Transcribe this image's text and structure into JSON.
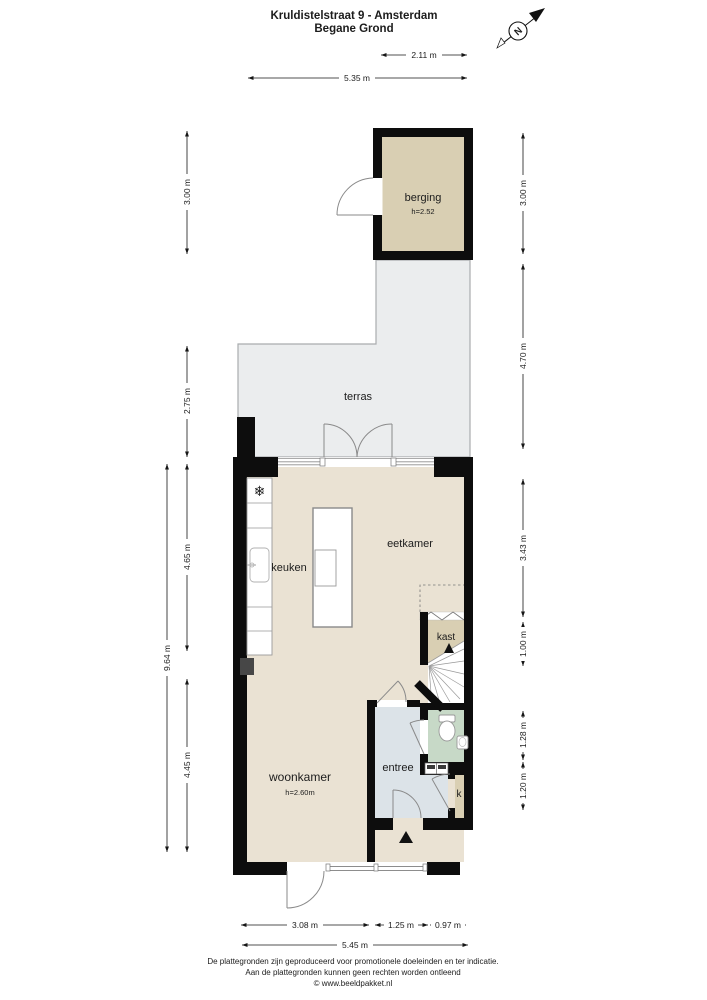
{
  "title": {
    "line1": "Kruldistelstraat 9 - Amsterdam",
    "line2": "Begane Grond"
  },
  "compass": {
    "letter": "N"
  },
  "rooms": {
    "berging": {
      "name": "berging",
      "height_note": "h=2.52"
    },
    "terras": {
      "name": "terras"
    },
    "eetkamer": {
      "name": "eetkamer"
    },
    "keuken": {
      "name": "keuken"
    },
    "kast": {
      "name": "kast"
    },
    "woonkamer": {
      "name": "woonkamer",
      "height_note": "h=2.60m"
    },
    "entree": {
      "name": "entree"
    },
    "k": {
      "name": "k"
    }
  },
  "dimensions": {
    "top_inner": "2.11 m",
    "top_outer": "5.35 m",
    "left_berging": "3.00 m",
    "left_terras": "2.75 m",
    "left_total": "9.64 m",
    "left_keuken": "4.65 m",
    "left_woonkamer": "4.45 m",
    "right_berging": "3.00 m",
    "right_terras": "4.70 m",
    "right_eetkamer": "3.43 m",
    "right_kast": "1.00 m",
    "right_toilet": "1.28 m",
    "right_entree": "1.20 m",
    "bottom_woonkamer": "3.08 m",
    "bottom_entree": "1.25 m",
    "bottom_right": "0.97 m",
    "bottom_total": "5.45 m"
  },
  "footer": {
    "line1": "De plattegronden zijn geproduceerd voor promotionele doeleinden en ter indicatie.",
    "line2": "Aan de plattegronden kunnen geen rechten worden ontleend",
    "line3": "© www.beeldpakket.nl"
  },
  "colors": {
    "wall": "#0d0d0d",
    "floor_main": "#eae2d3",
    "floor_berging": "#d9cfb3",
    "floor_terras": "#ebedee",
    "floor_entree": "#dce3e8",
    "floor_toilet": "#c7d9c7",
    "floor_kast": "#d9cfb3"
  }
}
